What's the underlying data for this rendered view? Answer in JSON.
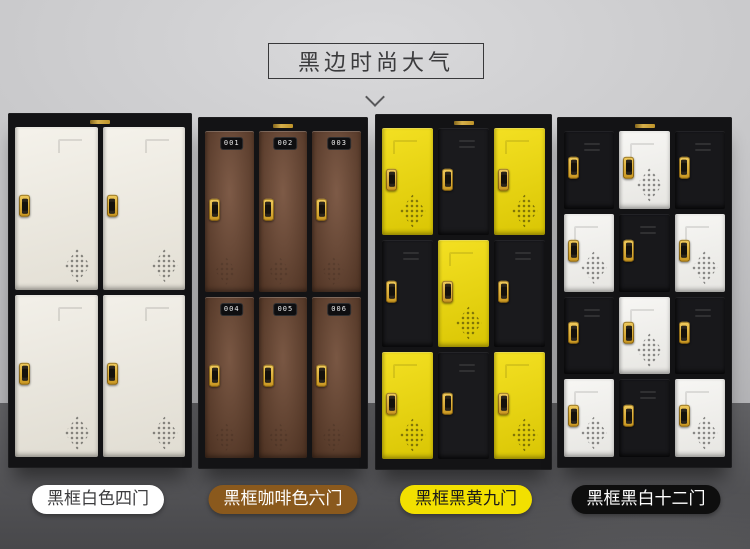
{
  "title": {
    "text": "黑边时尚大气"
  },
  "colors": {
    "wall": "#c9c9cb",
    "floor": "#535356",
    "frame_black": "#131315",
    "lock_gold": "#d8a520",
    "accent_yellow": "#f2dc04",
    "accent_coffee": "#6f4832"
  },
  "lockers": [
    {
      "id": "white-four-door",
      "label": "黑框白色四门",
      "label_bg": "#ffffff",
      "label_color": "#3c3c3e",
      "x": 8,
      "y": 113,
      "w": 184,
      "h": 355,
      "cols": 2,
      "rows": 2,
      "label_cx": 98,
      "doors": [
        {
          "color": "#efebe0",
          "color_name": "cream",
          "vent": true
        },
        {
          "color": "#efebe0",
          "color_name": "cream",
          "vent": true
        },
        {
          "color": "#ece8dd",
          "color_name": "cream",
          "vent": true
        },
        {
          "color": "#ece8dd",
          "color_name": "cream",
          "vent": true
        }
      ]
    },
    {
      "id": "coffee-six-door",
      "label": "黑框咖啡色六门",
      "label_bg": "#8a591d",
      "label_color": "#ffffff",
      "x": 198,
      "y": 117,
      "w": 170,
      "h": 352,
      "cols": 3,
      "rows": 2,
      "label_cx": 283,
      "doors": [
        {
          "color": "#6f4832",
          "color_name": "coffee",
          "number": "001",
          "vent": true
        },
        {
          "color": "#6f4832",
          "color_name": "coffee",
          "number": "002",
          "vent": true
        },
        {
          "color": "#6f4832",
          "color_name": "coffee",
          "number": "003",
          "vent": true
        },
        {
          "color": "#6a442e",
          "color_name": "coffee",
          "number": "004",
          "vent": true
        },
        {
          "color": "#6a442e",
          "color_name": "coffee",
          "number": "005",
          "vent": true
        },
        {
          "color": "#6a442e",
          "color_name": "coffee",
          "number": "006",
          "vent": true
        }
      ]
    },
    {
      "id": "black-yellow-nine-door",
      "label": "黑框黑黄九门",
      "label_bg": "#f2e000",
      "label_color": "#1a1a1a",
      "x": 375,
      "y": 114,
      "w": 177,
      "h": 356,
      "cols": 3,
      "rows": 3,
      "label_cx": 466,
      "doors": [
        {
          "color": "#f2dc04",
          "color_name": "yellow",
          "vent": true
        },
        {
          "color": "#1a1a1d",
          "color_name": "black"
        },
        {
          "color": "#f2dc04",
          "color_name": "yellow",
          "vent": true
        },
        {
          "color": "#1a1a1d",
          "color_name": "black"
        },
        {
          "color": "#f2dc04",
          "color_name": "yellow",
          "vent": true
        },
        {
          "color": "#1a1a1d",
          "color_name": "black"
        },
        {
          "color": "#f2dc04",
          "color_name": "yellow",
          "vent": true
        },
        {
          "color": "#1a1a1d",
          "color_name": "black"
        },
        {
          "color": "#f2dc04",
          "color_name": "yellow",
          "vent": true
        }
      ]
    },
    {
      "id": "black-white-twelve-door",
      "label": "黑框黑白十二门",
      "label_bg": "#0e0e0e",
      "label_color": "#ffffff",
      "x": 557,
      "y": 117,
      "w": 175,
      "h": 351,
      "cols": 3,
      "rows": 4,
      "label_cx": 646,
      "doors": [
        {
          "color": "#18181b",
          "color_name": "black"
        },
        {
          "color": "#f3f2ee",
          "color_name": "white",
          "vent": true
        },
        {
          "color": "#18181b",
          "color_name": "black"
        },
        {
          "color": "#f3f2ee",
          "color_name": "white",
          "vent": true
        },
        {
          "color": "#18181b",
          "color_name": "black"
        },
        {
          "color": "#f3f2ee",
          "color_name": "white",
          "vent": true
        },
        {
          "color": "#18181b",
          "color_name": "black"
        },
        {
          "color": "#f3f2ee",
          "color_name": "white",
          "vent": true
        },
        {
          "color": "#18181b",
          "color_name": "black"
        },
        {
          "color": "#f3f2ee",
          "color_name": "white",
          "vent": true
        },
        {
          "color": "#18181b",
          "color_name": "black"
        },
        {
          "color": "#f3f2ee",
          "color_name": "white",
          "vent": true
        }
      ]
    }
  ]
}
